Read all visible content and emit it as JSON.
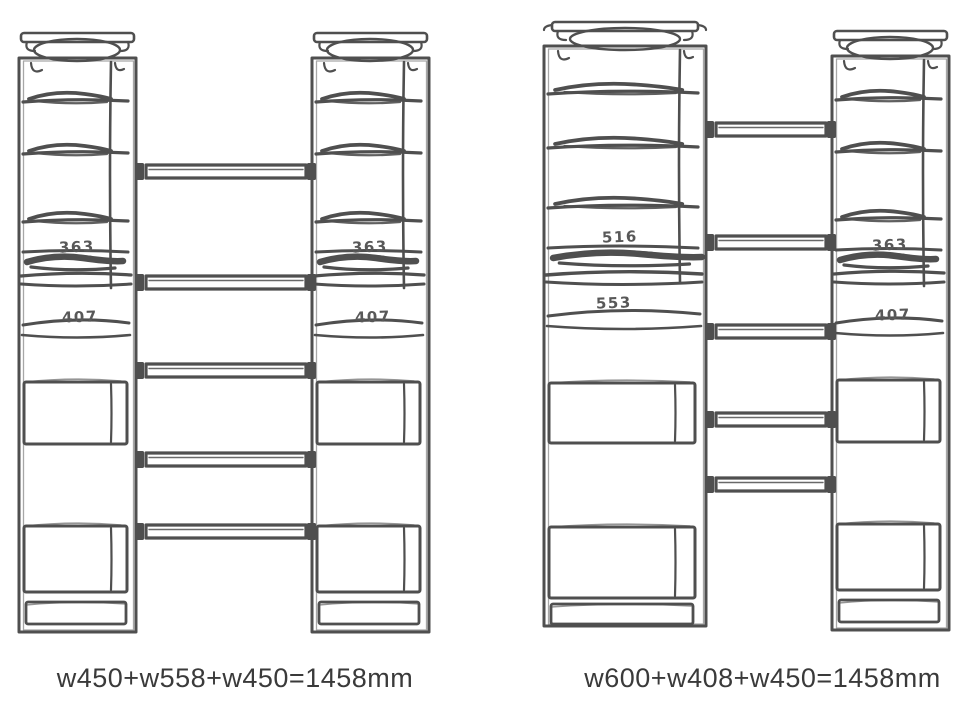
{
  "colors": {
    "background": "#ffffff",
    "sketch_stroke": "#4f4f4f",
    "dimension_label": "#585858",
    "caption_text": "#3a3a3a"
  },
  "diagrams": [
    {
      "caption": "w450+w558+w450=1458mm",
      "crossbar_count": 5,
      "towers": [
        {
          "position": "left",
          "width": "w450",
          "shelf_label_top": "363",
          "shelf_label_bottom": "407"
        },
        {
          "position": "right",
          "width": "w450",
          "shelf_label_top": "363",
          "shelf_label_bottom": "407"
        }
      ]
    },
    {
      "caption": "w600+w408+w450=1458mm",
      "crossbar_count": 5,
      "towers": [
        {
          "position": "left",
          "width": "w600",
          "shelf_label_top": "516",
          "shelf_label_bottom": "553"
        },
        {
          "position": "right",
          "width": "w450",
          "shelf_label_top": "363",
          "shelf_label_bottom": "407"
        }
      ]
    }
  ]
}
